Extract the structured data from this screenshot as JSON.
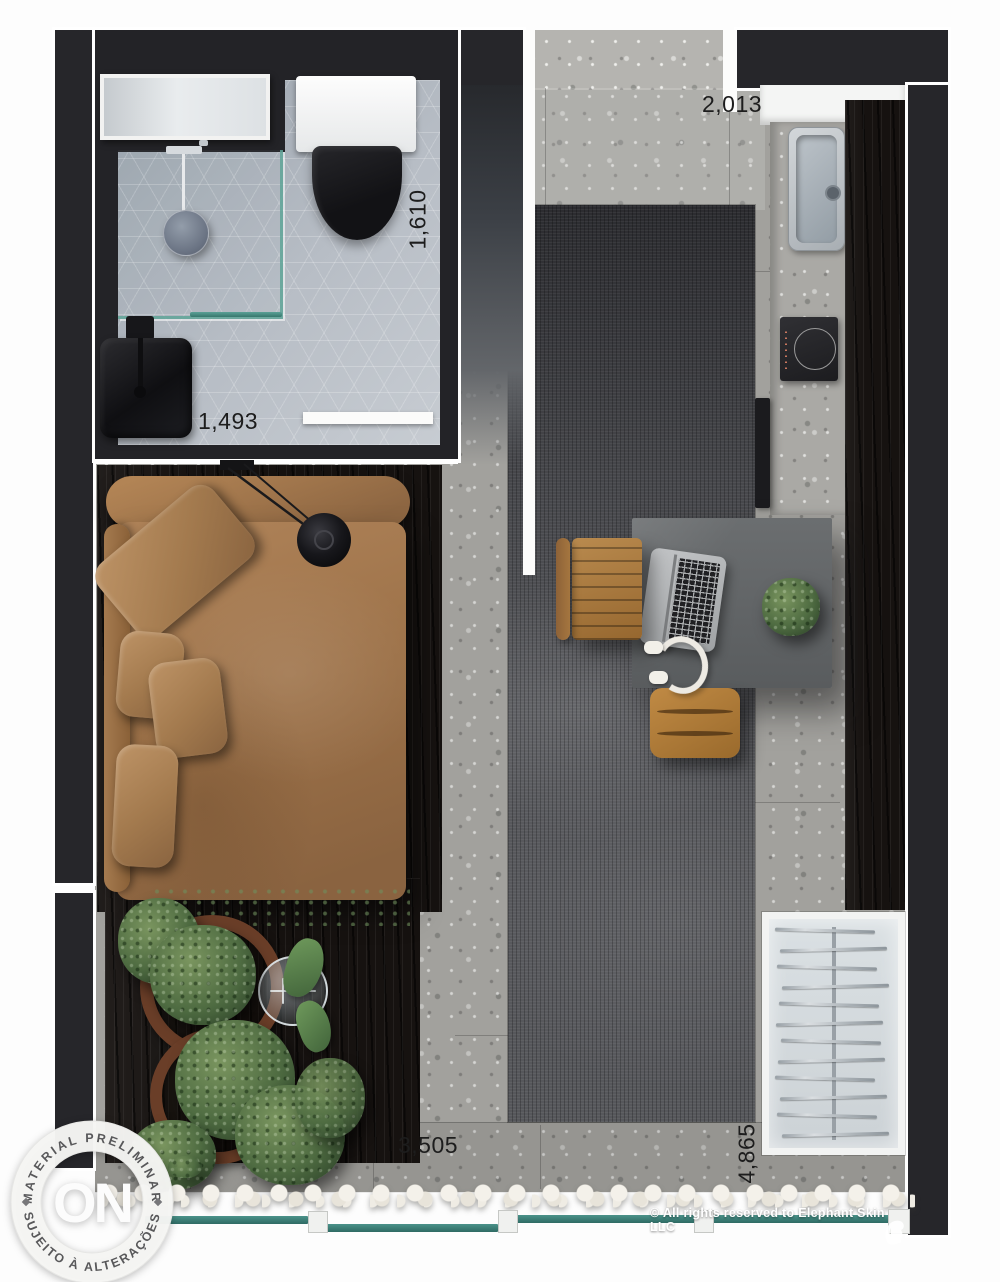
{
  "title": "Studio apartment floor plan render",
  "dimensions": {
    "entry": "2,013",
    "bath_depth": "1,610",
    "bath_width": "1,493",
    "living_width": "3,505",
    "living_depth": "4,865"
  },
  "stamp": {
    "top": "MATERIAL PRELIMINAR",
    "bottom": "SUJEITO À ALTERAÇÕES",
    "logo": "ON"
  },
  "footer": {
    "copyright": "© All rights reserved to Elephant Skin LLC"
  },
  "wardrobe": {
    "hanger_count": 12
  },
  "palette": {
    "wall": "#26262a",
    "tile": "#a7afba",
    "floor_terrazzo": "#a2a19d",
    "rug": "#56575b",
    "bed_leather": "#a87e57",
    "wood_dark": "#161210",
    "glass_teal": "#3d8078",
    "plant_green": "#4c6b3f",
    "pot_terracotta": "#6a3e28"
  }
}
